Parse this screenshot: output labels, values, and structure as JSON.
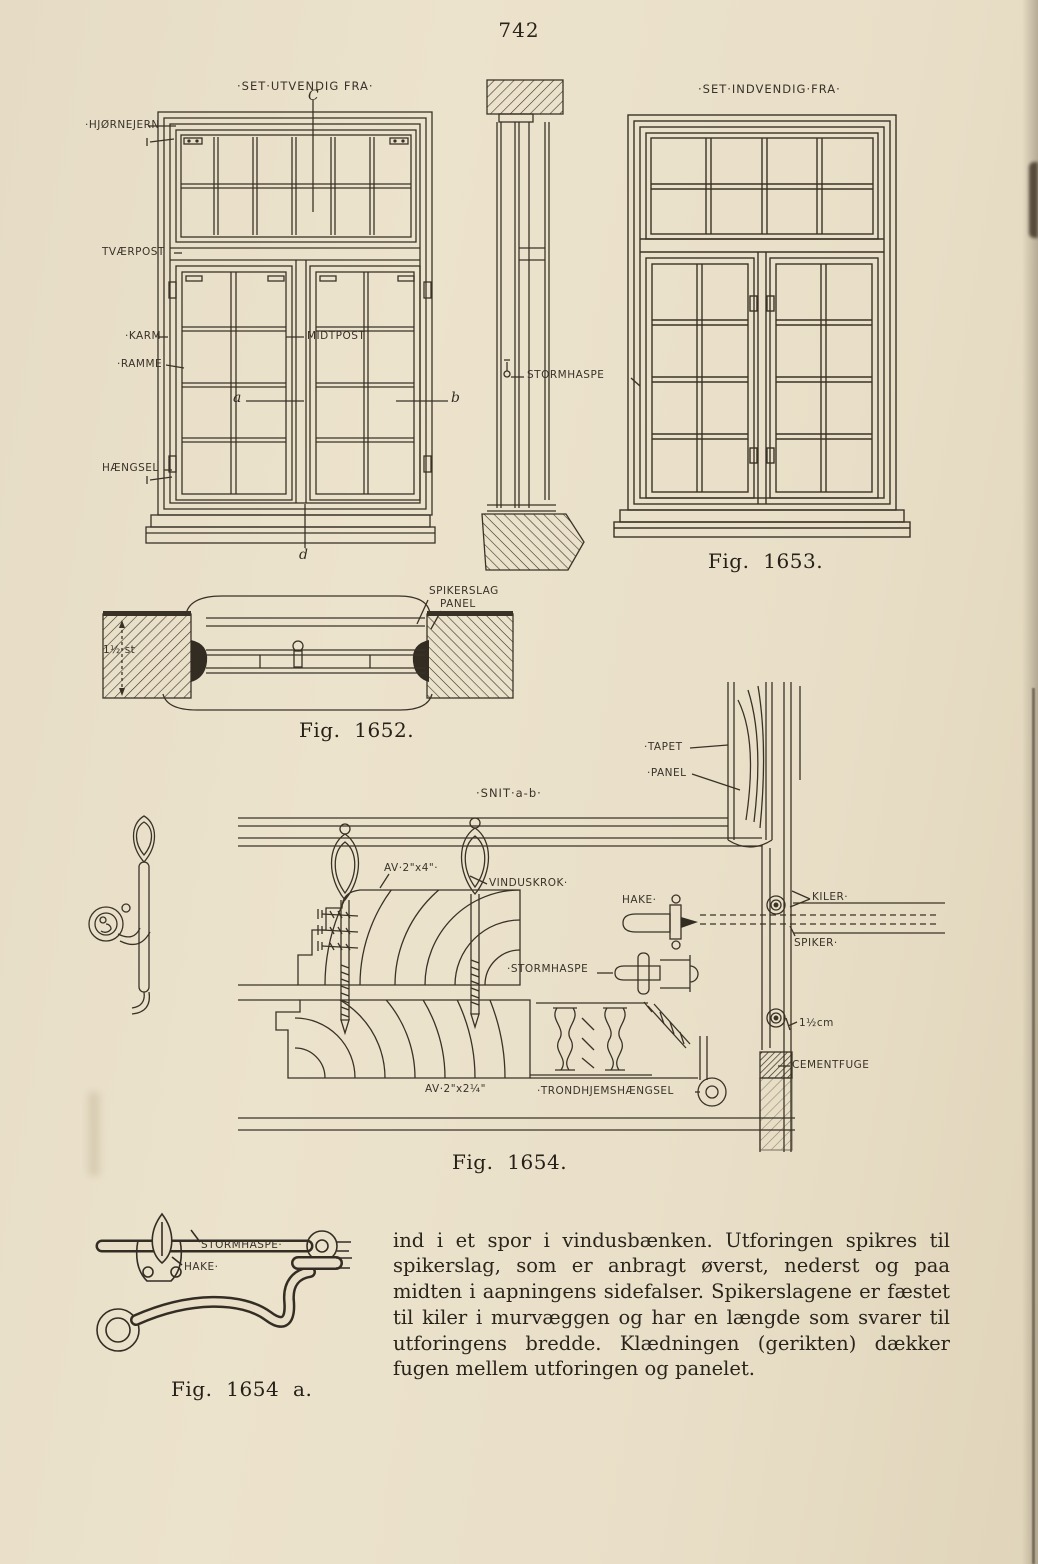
{
  "page": {
    "number": "742"
  },
  "fig1653": {
    "caption": "Fig. 1653.",
    "exterior_title": "·SET·UTVENDIG FRA·",
    "interior_title": "·SET·INDVENDIG·FRA·",
    "labels": {
      "hjornejern": "·HJØRNEJERN",
      "tvaerpost": "TVÆRPOST",
      "karm": "·KARM",
      "ramme": "·RAMME",
      "haengsel": "HÆNGSEL",
      "midtpost": "MIDTPOST",
      "stormhaspe": "STORMHASPE"
    },
    "letters": {
      "a": "a",
      "b": "b",
      "c": "C",
      "d": "d"
    }
  },
  "fig1652": {
    "caption": "Fig. 1652.",
    "labels": {
      "spikerslag": "SPIKERSLAG",
      "panel": "PANEL",
      "wall_thickness": "1½ st"
    }
  },
  "fig1654": {
    "caption": "Fig. 1654.",
    "section_title": "·SNIT·a-b·",
    "labels": {
      "tapet": "·TAPET",
      "panel": "·PANEL",
      "av2x4": "AV·2\"x4\"·",
      "vinduskrok": "VINDUSKROK·",
      "hake": "HAKE·",
      "kiler": "KILER·",
      "spiker": "SPIKER·",
      "stormhaspe": "·STORMHASPE",
      "cm": "1½cm",
      "cementfuge": "CEMENTFUGE",
      "av2x214": "AV·2\"x2¼\"",
      "trondhjemshaengsel": "·TRONDHJEMSHÆNGSEL"
    }
  },
  "fig1654a": {
    "caption": "Fig. 1654 a.",
    "labels": {
      "stormhaspe": "STORMHASPE·",
      "hake": "HAKE·"
    }
  },
  "body_text": "ind i et spor i vindusbænken. Utforingen spikres til spikerslag, som er anbragt øverst, nederst og paa midten i aapningens sidefalser. Spikerslagene er fæstet til kiler i murvæggen og har en længde som svarer til utforingens bredde. Klædningen (gerikten) dækker fugen mellem utforingen og panelet."
}
